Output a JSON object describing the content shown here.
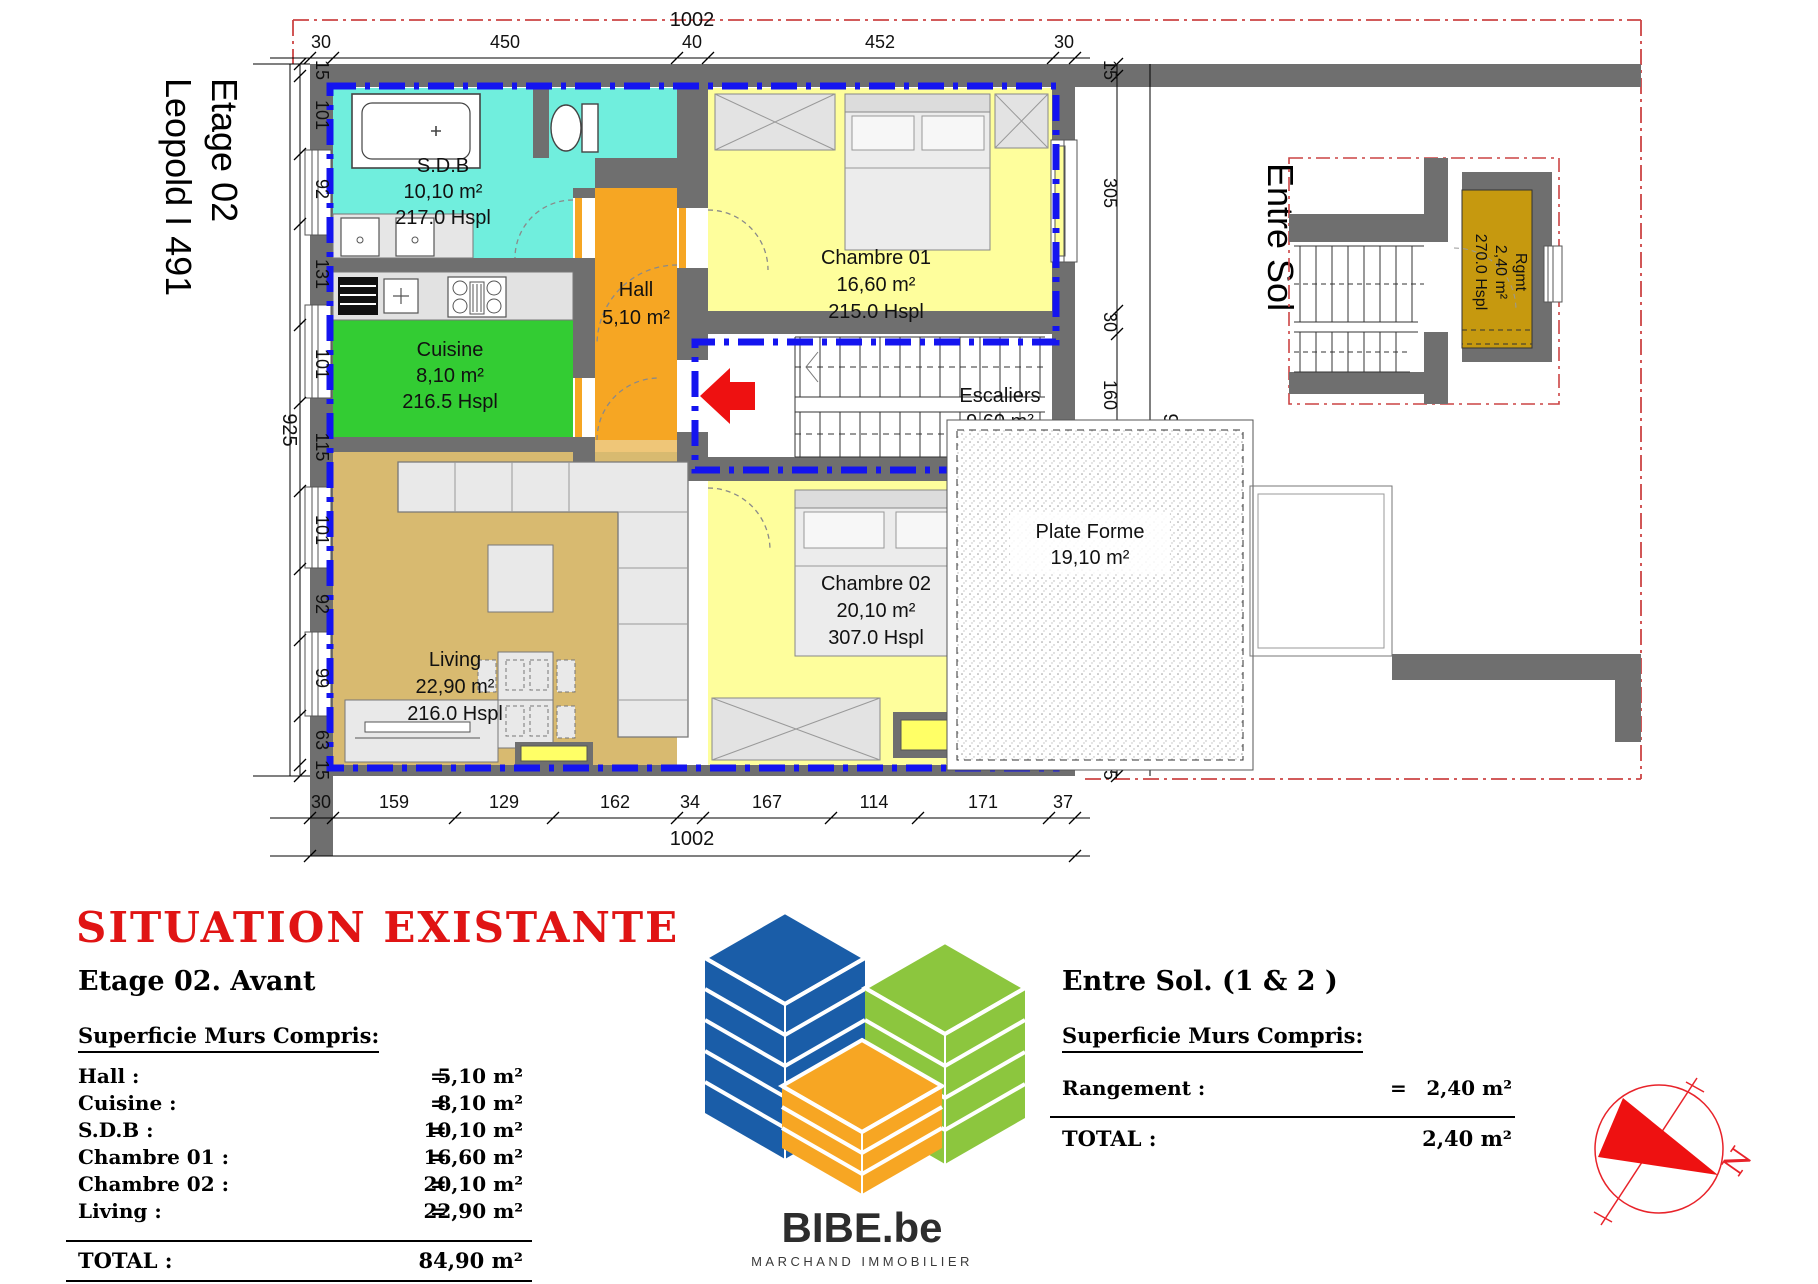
{
  "side_label": {
    "line1": "Etage 02",
    "line2": "Leopold I 491"
  },
  "entre_sol_label": "Entre Sol",
  "rooms": {
    "sdb": {
      "name": "S.D.B",
      "area": "10,10 m²",
      "hspl": "217.0 Hspl"
    },
    "cuisine": {
      "name": "Cuisine",
      "area": "8,10 m²",
      "hspl": "216.5 Hspl"
    },
    "hall": {
      "name": "Hall",
      "area": "5,10 m²"
    },
    "chambre1": {
      "name": "Chambre 01",
      "area": "16,60 m²",
      "hspl": "215.0 Hspl"
    },
    "escaliers": {
      "name": "Escaliers",
      "area": "9,60 m²"
    },
    "living": {
      "name": "Living",
      "area": "22,90 m²",
      "hspl": "216.0 Hspl"
    },
    "chambre2": {
      "name": "Chambre 02",
      "area": "20,10 m²",
      "hspl": "307.0 Hspl"
    },
    "plate_forme": {
      "name": "Plate Forme",
      "area": "19,10 m²"
    },
    "rgmt": {
      "name": "Rgmt",
      "area": "2,40 m²",
      "hspl": "270.0 Hspl"
    }
  },
  "dims": {
    "top": {
      "overall": "1002",
      "parts": [
        "30",
        "450",
        "40",
        "452",
        "30"
      ]
    },
    "bottom": {
      "overall": "1002",
      "parts": [
        "30",
        "159",
        "129",
        "162",
        "34",
        "167",
        "114",
        "171",
        "37"
      ]
    },
    "left": {
      "overall": "925",
      "parts": [
        "15",
        "101",
        "92",
        "131",
        "101",
        "115",
        "101",
        "92",
        "99",
        "63",
        "15"
      ]
    },
    "right": {
      "overall": "925",
      "parts": [
        "15",
        "305",
        "30",
        "160",
        "31",
        "369",
        "15"
      ]
    }
  },
  "legend_left": {
    "title": "SITUATION EXISTANTE",
    "subtitle": "Etage 02. Avant",
    "heading": "Superficie Murs Compris:",
    "rows": [
      {
        "label": "Hall :",
        "eq": "=",
        "value": "5,10 m²"
      },
      {
        "label": "Cuisine :",
        "eq": "=",
        "value": "8,10 m²"
      },
      {
        "label": "S.D.B :",
        "eq": "=",
        "value": "10,10 m²"
      },
      {
        "label": "Chambre 01  :",
        "eq": "=",
        "value": "16,60 m²"
      },
      {
        "label": "Chambre 02 :",
        "eq": "=",
        "value": "20,10 m²"
      },
      {
        "label": "Living :",
        "eq": "=",
        "value": "22,90 m²"
      }
    ],
    "total_label": "TOTAL :",
    "total_value": "84,90 m²"
  },
  "legend_right": {
    "title": "Entre Sol. (1 & 2 )",
    "heading": "Superficie Murs Compris:",
    "rows": [
      {
        "label": "Rangement :",
        "eq": "=",
        "value": "2,40 m²"
      }
    ],
    "total_label": "TOTAL :",
    "total_value": "2,40 m²"
  },
  "logo": {
    "brand": "BIBE.be",
    "tagline": "MARCHAND IMMOBILIER"
  },
  "compass": {
    "letter": "N"
  }
}
